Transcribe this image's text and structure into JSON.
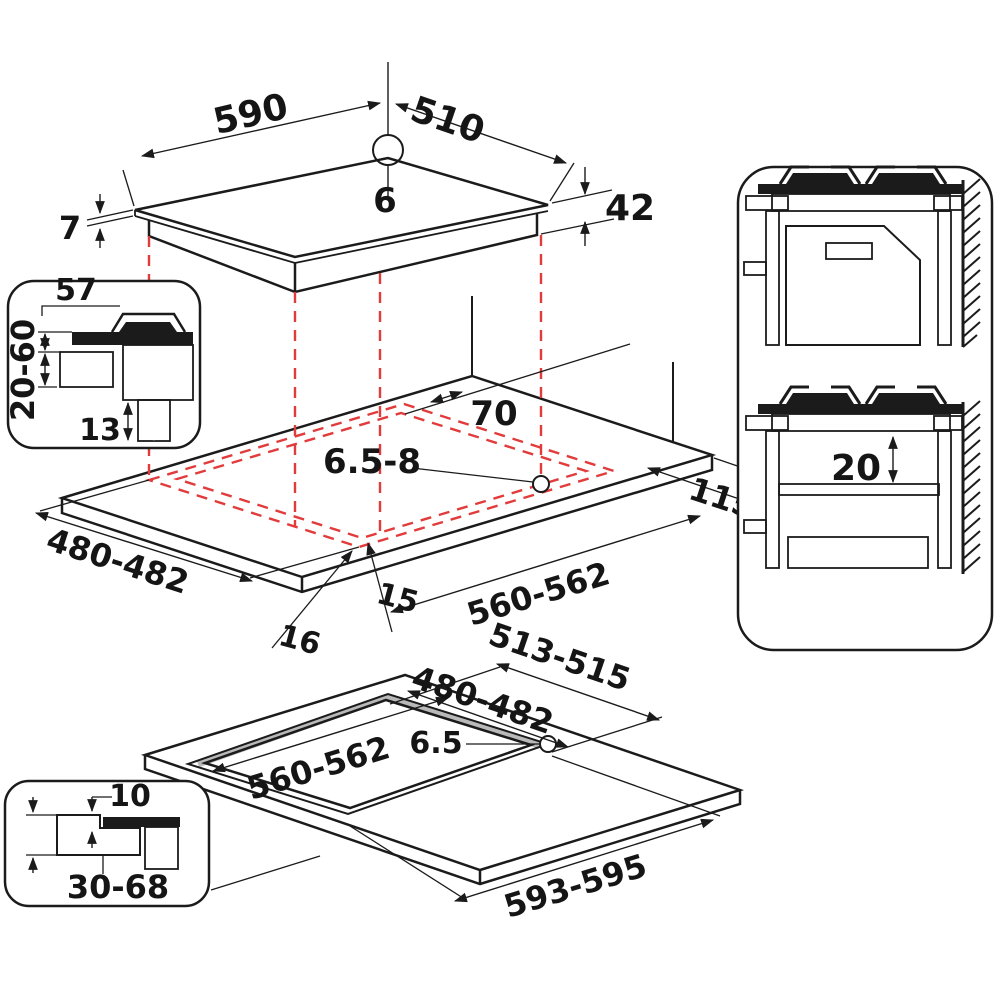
{
  "title": "Gas hob installation dimensions diagram",
  "colors": {
    "line": "#1b1b1b",
    "cutout_red": "#e23b3b",
    "gray_light": "#d9d9d9",
    "gray_mid": "#bfbfbf",
    "gray_dark": "#8f8f8f"
  },
  "dims": {
    "hob": {
      "width": "590",
      "depth": "510",
      "hole_dia": "6",
      "glass_thickness": "7",
      "body_height": "42"
    },
    "section": {
      "front_overhang": "57",
      "worktop_thickness": "20-60",
      "gas_inlet": "13"
    },
    "cutout": {
      "rear_clearance": "70",
      "fixing_holes": "6.5-8",
      "right_clearance": "115",
      "depth": "480-482",
      "width": "560-562",
      "front_gap": "16",
      "side_gap": "15"
    },
    "cabinet": {
      "shelf_gap": "20"
    },
    "flush": {
      "outer_depth": "513-515",
      "depth": "480-482",
      "width": "560-562",
      "fixing_hole": "6.5",
      "outer_width": "593-595"
    },
    "flush_section": {
      "rebate_depth": "10",
      "worktop_thickness": "30-68"
    }
  }
}
